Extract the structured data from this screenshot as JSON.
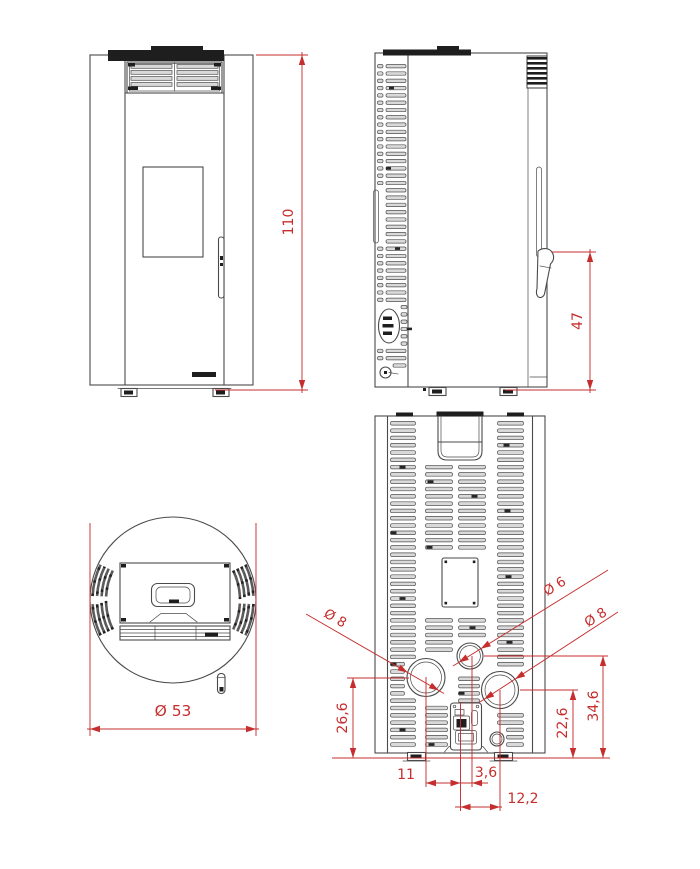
{
  "drawing": {
    "kind": "pellet-stove dimensioned technical drawing",
    "views": {
      "front": {
        "height_dim": "110"
      },
      "side": {
        "handle_height_dim": "47"
      },
      "top": {
        "diameter_dim": "Ø 53"
      },
      "rear": {
        "left_flue_diameter": "Ø 8",
        "air_intake_diameter": "Ø 6",
        "right_flue_diameter": "Ø 8",
        "left_flue_center_height": "26,6",
        "right_flue_center_height": "22,6",
        "air_intake_center_height": "34,6",
        "left_flue_offset_x": "11",
        "air_intake_offset_x": "3,6",
        "right_flue_offset_x": "12,2"
      }
    },
    "colors": {
      "dimension_red": "#c62e2e",
      "line_gray": "#4a4a4a",
      "slot_fill": "#d9d9d9",
      "dark_fill": "#1e1e1e",
      "background": "#ffffff"
    }
  }
}
